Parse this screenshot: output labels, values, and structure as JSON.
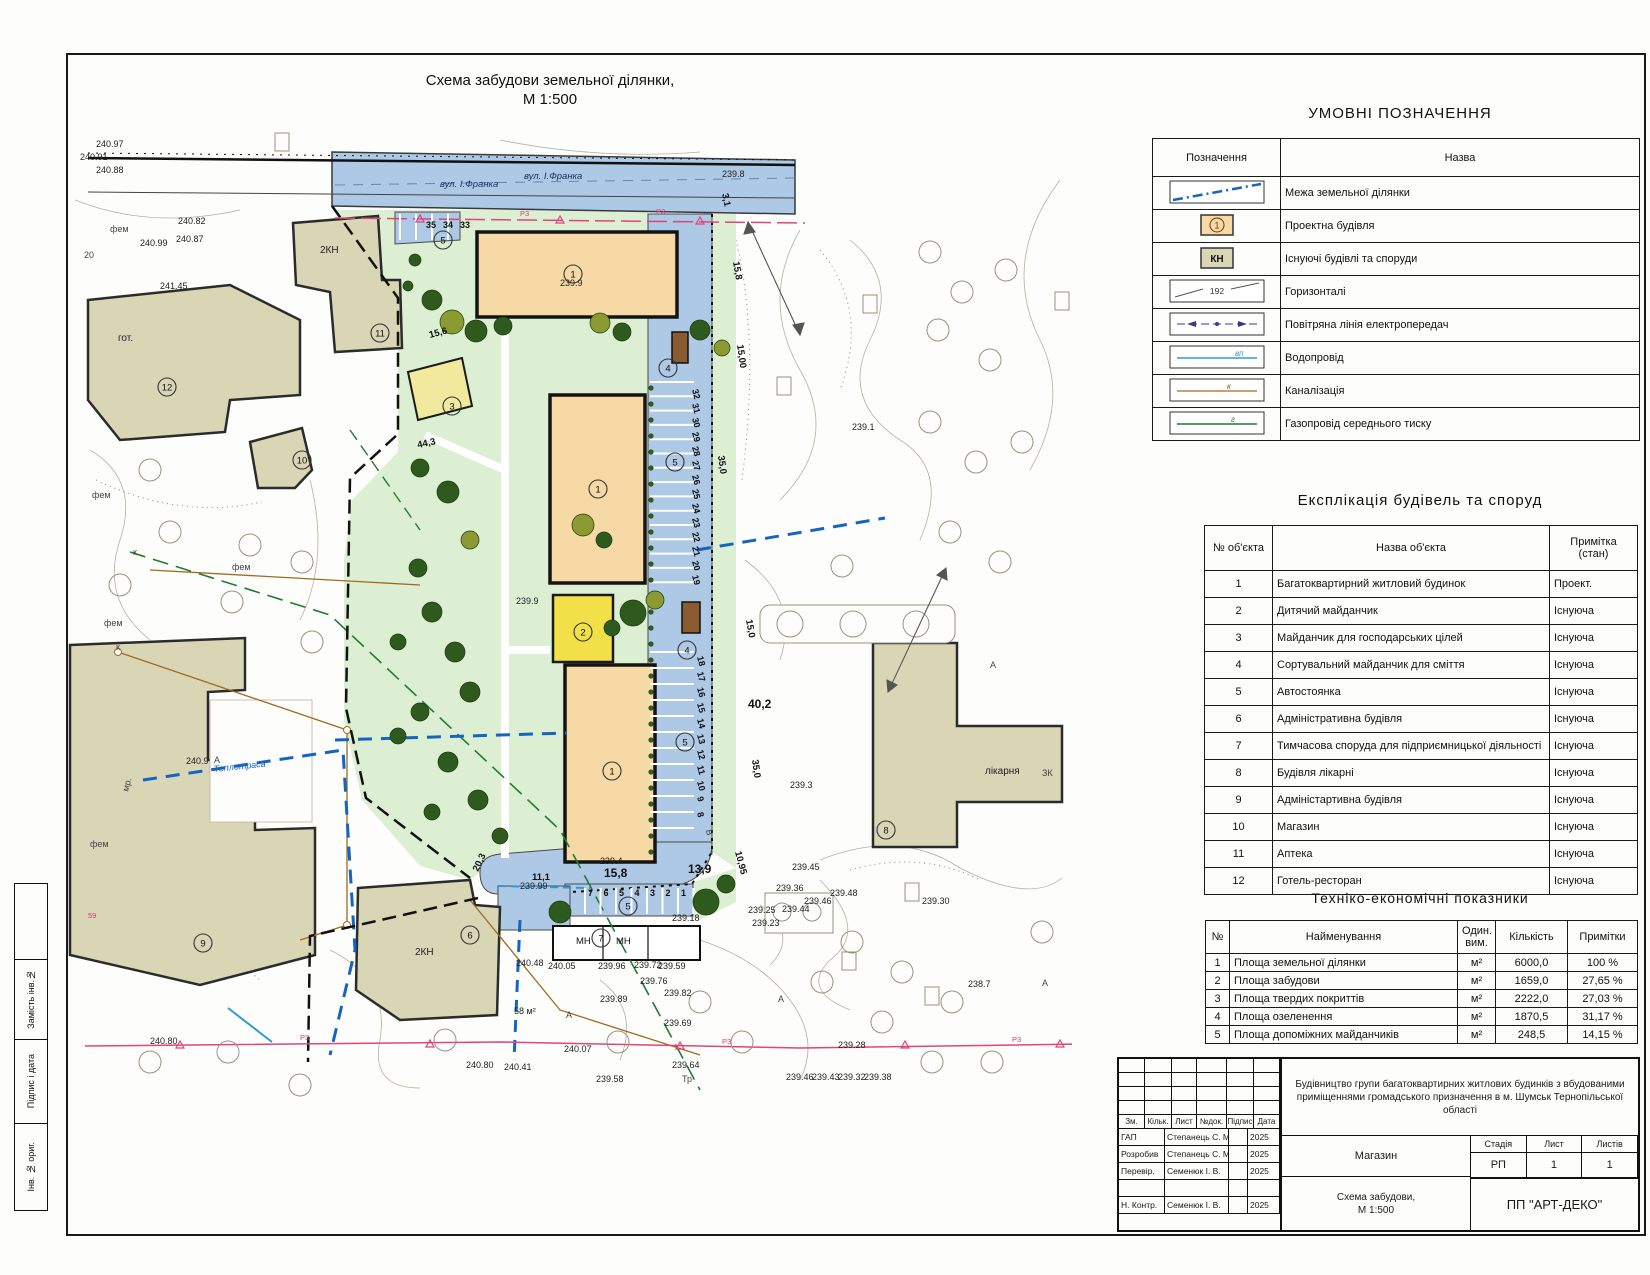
{
  "sheet": {
    "title_line1": "Схема забудови земельної ділянки,",
    "title_line2": "М 1:500"
  },
  "side_strip": [
    "Замість інв.№",
    "Підпис і дата",
    "Інв. № ориг."
  ],
  "legend": {
    "title": "УМОВНІ ПОЗНАЧЕННЯ",
    "col_symbol": "Позначення",
    "col_name": "Назва",
    "rows": [
      {
        "symbol": "boundary-line",
        "name": "Межа земельної ділянки",
        "badge": ""
      },
      {
        "symbol": "project-building",
        "name": "Проектна будівля",
        "badge": "1"
      },
      {
        "symbol": "existing-building",
        "name": "Існуючі будівлі та споруди",
        "badge": "КН"
      },
      {
        "symbol": "contour",
        "name": "Горизонталі",
        "badge": "192"
      },
      {
        "symbol": "powerline",
        "name": "Повітряна лінія електропередач",
        "badge": ""
      },
      {
        "symbol": "water",
        "name": "Водопровід",
        "badge": "вп"
      },
      {
        "symbol": "sewer",
        "name": "Каналізація",
        "badge": "к"
      },
      {
        "symbol": "gas",
        "name": "Газопровід середнього тиску",
        "badge": "г"
      }
    ]
  },
  "explication": {
    "title": "Експлікація будівель та споруд",
    "col_num": "№ об'єкта",
    "col_name": "Назва об'єкта",
    "col_note": "Примітка (стан)",
    "rows": [
      {
        "num": "1",
        "name": "Багатоквартирний житловий будинок",
        "note": "Проект."
      },
      {
        "num": "2",
        "name": "Дитячий майданчик",
        "note": "Існуюча"
      },
      {
        "num": "3",
        "name": "Майданчик для господарських цілей",
        "note": "Існуюча"
      },
      {
        "num": "4",
        "name": "Сортувальний майданчик для сміття",
        "note": "Існуюча"
      },
      {
        "num": "5",
        "name": "Автостоянка",
        "note": "Існуюча"
      },
      {
        "num": "6",
        "name": "Адміністративна будівля",
        "note": "Існуюча"
      },
      {
        "num": "7",
        "name": "Тимчасова споруда для підприємницької діяльності",
        "note": "Існуюча"
      },
      {
        "num": "8",
        "name": "Будівля лікарні",
        "note": "Існуюча"
      },
      {
        "num": "9",
        "name": "Адміністартивна будівля",
        "note": "Існуюча"
      },
      {
        "num": "10",
        "name": "Магазин",
        "note": "Існуюча"
      },
      {
        "num": "11",
        "name": "Аптека",
        "note": "Існуюча"
      },
      {
        "num": "12",
        "name": "Готель-ресторан",
        "note": "Існуюча"
      }
    ]
  },
  "indicators": {
    "title": "Техніко-економічні показники",
    "col_num": "№",
    "col_name": "Найменування",
    "col_unit": "Один. вим.",
    "col_qty": "Кількість",
    "col_note": "Примітки",
    "rows": [
      {
        "num": "1",
        "name": "Площа земельної ділянки",
        "unit": "м²",
        "qty": "6000,0",
        "note": "100 %"
      },
      {
        "num": "2",
        "name": "Площа забудови",
        "unit": "м²",
        "qty": "1659,0",
        "note": "27,65 %"
      },
      {
        "num": "3",
        "name": "Площа твердих покриттів",
        "unit": "м²",
        "qty": "2222,0",
        "note": "27,03 %"
      },
      {
        "num": "4",
        "name": "Площа озеленення",
        "unit": "м²",
        "qty": "1870,5",
        "note": "31,17 %"
      },
      {
        "num": "5",
        "name": "Площа допоміжних майданчиків",
        "unit": "м²",
        "qty": "248,5",
        "note": "14,15 %"
      }
    ]
  },
  "title_block": {
    "sig_headers": [
      "Зм.",
      "Кільк.",
      "Лист",
      "№док.",
      "Підпис",
      "Дата"
    ],
    "sig_rows": [
      {
        "role": "ГАП",
        "name": "Степанець С. М.",
        "sign": "",
        "date": "2025"
      },
      {
        "role": "Розробив",
        "name": "Степанець С. М.",
        "sign": "",
        "date": "2025"
      },
      {
        "role": "Перевір.",
        "name": "Семенюк І. В.",
        "sign": "",
        "date": "2025"
      },
      {
        "role": "",
        "name": "",
        "sign": "",
        "date": ""
      },
      {
        "role": "Н. Контр.",
        "name": "Семенюк І. В.",
        "sign": "",
        "date": "2025"
      }
    ],
    "project": "Будівництво групи багатоквартирних житлових будинків з вбудованими приміщеннями громадського призначення в м. Шумськ Тернопільської області",
    "object": "Магазин",
    "stage_label": "Стадія",
    "sheet_label": "Лист",
    "sheets_label": "Листів",
    "stage": "РП",
    "sheet": "1",
    "sheets": "1",
    "doc_line1": "Схема забудови,",
    "doc_line2": "М 1:500",
    "company": "ПП \"АРТ-ДЕКО\""
  },
  "map": {
    "colors": {
      "road": "#adc9e5",
      "lawn": "#dcefd3",
      "project_building": "#f6d9a4",
      "existing_building": "#d9d6b6",
      "playground": "#f2e049",
      "utility_pad": "#f1ea9e",
      "boundary_blue": "#1565c0",
      "gas_green": "#1f7d32",
      "sewer_tan": "#a06a1f",
      "pink_line": "#e0457b",
      "tree_dark": "#2f5a1d",
      "tree_olive": "#8c9b31"
    },
    "labels": [
      {
        "t": "вул. І.Франка",
        "x": 440,
        "y": 187,
        "c": "street"
      },
      {
        "t": "вул. І.Франка",
        "x": 524,
        "y": 179,
        "c": "street"
      },
      {
        "t": "239.8",
        "x": 722,
        "y": 177,
        "c": "elev"
      },
      {
        "t": "240.97",
        "x": 96,
        "y": 147,
        "c": "elev"
      },
      {
        "t": "240.91",
        "x": 80,
        "y": 160,
        "c": "elev"
      },
      {
        "t": "240.88",
        "x": 96,
        "y": 173,
        "c": "elev"
      },
      {
        "t": "240.82",
        "x": 178,
        "y": 224,
        "c": "elev"
      },
      {
        "t": "240.99",
        "x": 140,
        "y": 246,
        "c": "elev"
      },
      {
        "t": "240.87",
        "x": 176,
        "y": 242,
        "c": "elev"
      },
      {
        "t": "241.45",
        "x": 160,
        "y": 289,
        "c": "elev"
      },
      {
        "t": "20",
        "x": 84,
        "y": 258,
        "c": "letter"
      },
      {
        "t": "гот.",
        "x": 118,
        "y": 341,
        "c": "nameb"
      },
      {
        "t": "2КН",
        "x": 320,
        "y": 253,
        "c": "nameb"
      },
      {
        "t": "2КН",
        "x": 415,
        "y": 955,
        "c": "nameb"
      },
      {
        "t": "мр.",
        "x": 128,
        "y": 792,
        "c": "letter",
        "r": -75
      },
      {
        "t": "фем",
        "x": 110,
        "y": 232,
        "c": "letter"
      },
      {
        "t": "фем",
        "x": 92,
        "y": 498,
        "c": "letter"
      },
      {
        "t": "фем",
        "x": 104,
        "y": 626,
        "c": "letter"
      },
      {
        "t": "фем",
        "x": 90,
        "y": 847,
        "c": "letter"
      },
      {
        "t": "фем",
        "x": 232,
        "y": 570,
        "c": "letter"
      },
      {
        "t": "к",
        "x": 133,
        "y": 555,
        "c": "letter"
      },
      {
        "t": "к",
        "x": 116,
        "y": 650,
        "c": "letter"
      },
      {
        "t": "35",
        "x": 426,
        "y": 228,
        "c": "stall"
      },
      {
        "t": "34",
        "x": 443,
        "y": 228,
        "c": "stall"
      },
      {
        "t": "33",
        "x": 460,
        "y": 228,
        "c": "stall"
      },
      {
        "t": "15,6",
        "x": 430,
        "y": 338,
        "c": "dim",
        "r": -15
      },
      {
        "t": "44,3",
        "x": 418,
        "y": 448,
        "c": "dim",
        "r": -12
      },
      {
        "t": "239.9",
        "x": 560,
        "y": 286,
        "c": "elev"
      },
      {
        "t": "239.9",
        "x": 516,
        "y": 604,
        "c": "elev"
      },
      {
        "t": "239.1",
        "x": 852,
        "y": 430,
        "c": "elev"
      },
      {
        "t": "3,1",
        "x": 722,
        "y": 194,
        "c": "dim",
        "r": 78
      },
      {
        "t": "15,8",
        "x": 733,
        "y": 262,
        "c": "dim",
        "r": 80
      },
      {
        "t": "15,00",
        "x": 737,
        "y": 345,
        "c": "dim",
        "r": 82
      },
      {
        "t": "35,0",
        "x": 718,
        "y": 456,
        "c": "dim",
        "r": 82
      },
      {
        "t": "15,0",
        "x": 746,
        "y": 620,
        "c": "dim",
        "r": 80
      },
      {
        "t": "40,2",
        "x": 748,
        "y": 708,
        "c": "dimb"
      },
      {
        "t": "35,0",
        "x": 752,
        "y": 760,
        "c": "dim",
        "r": 82
      },
      {
        "t": "10,95",
        "x": 735,
        "y": 852,
        "c": "dim",
        "r": 75
      },
      {
        "t": "239.3",
        "x": 790,
        "y": 788,
        "c": "elev"
      },
      {
        "t": "лікарня",
        "x": 985,
        "y": 774,
        "c": "nameb"
      },
      {
        "t": "ЗК",
        "x": 1042,
        "y": 776,
        "c": "letter"
      },
      {
        "t": "А",
        "x": 990,
        "y": 668,
        "c": "letter"
      },
      {
        "t": "А",
        "x": 214,
        "y": 763,
        "c": "letter"
      },
      {
        "t": "А",
        "x": 778,
        "y": 1002,
        "c": "letter"
      },
      {
        "t": "А",
        "x": 1042,
        "y": 986,
        "c": "letter"
      },
      {
        "t": "А",
        "x": 566,
        "y": 1018,
        "c": "letter"
      },
      {
        "t": "20,3",
        "x": 478,
        "y": 872,
        "c": "dim",
        "r": -65
      },
      {
        "t": "11,1",
        "x": 532,
        "y": 880,
        "c": "dim"
      },
      {
        "t": "239.99",
        "x": 520,
        "y": 889,
        "c": "elev"
      },
      {
        "t": "239.4",
        "x": 600,
        "y": 864,
        "c": "elev"
      },
      {
        "t": "15,8",
        "x": 604,
        "y": 877,
        "c": "dimb"
      },
      {
        "t": "13,9",
        "x": 688,
        "y": 873,
        "c": "dimb"
      },
      {
        "t": "239.18",
        "x": 672,
        "y": 921,
        "c": "elev"
      },
      {
        "t": "МН",
        "x": 576,
        "y": 944,
        "c": "ctext"
      },
      {
        "t": "МН",
        "x": 616,
        "y": 944,
        "c": "ctext"
      },
      {
        "t": "В",
        "x": 706,
        "y": 830,
        "c": "letter",
        "r": 80
      },
      {
        "t": "240.48",
        "x": 516,
        "y": 966,
        "c": "elev"
      },
      {
        "t": "240.05",
        "x": 548,
        "y": 969,
        "c": "elev"
      },
      {
        "t": "239.96",
        "x": 598,
        "y": 969,
        "c": "elev"
      },
      {
        "t": "239.72",
        "x": 634,
        "y": 968,
        "c": "elev"
      },
      {
        "t": "239.59",
        "x": 658,
        "y": 969,
        "c": "elev"
      },
      {
        "t": "239.76",
        "x": 640,
        "y": 984,
        "c": "elev"
      },
      {
        "t": "239.82",
        "x": 664,
        "y": 996,
        "c": "elev"
      },
      {
        "t": "239.89",
        "x": 600,
        "y": 1002,
        "c": "elev"
      },
      {
        "t": "239.69",
        "x": 664,
        "y": 1026,
        "c": "elev"
      },
      {
        "t": "58 м²",
        "x": 514,
        "y": 1014,
        "c": "elev"
      },
      {
        "t": "240.07",
        "x": 564,
        "y": 1052,
        "c": "elev"
      },
      {
        "t": "240.80",
        "x": 150,
        "y": 1044,
        "c": "elev"
      },
      {
        "t": "240.80",
        "x": 466,
        "y": 1068,
        "c": "elev"
      },
      {
        "t": "240.41",
        "x": 504,
        "y": 1070,
        "c": "elev"
      },
      {
        "t": "239.64",
        "x": 672,
        "y": 1068,
        "c": "elev"
      },
      {
        "t": "239.58",
        "x": 596,
        "y": 1082,
        "c": "elev"
      },
      {
        "t": "Тр",
        "x": 682,
        "y": 1082,
        "c": "letter"
      },
      {
        "t": "239.46",
        "x": 786,
        "y": 1080,
        "c": "elev"
      },
      {
        "t": "239.43",
        "x": 812,
        "y": 1080,
        "c": "elev"
      },
      {
        "t": "239.32",
        "x": 838,
        "y": 1080,
        "c": "elev"
      },
      {
        "t": "239.38",
        "x": 864,
        "y": 1080,
        "c": "elev"
      },
      {
        "t": "239.28",
        "x": 838,
        "y": 1048,
        "c": "elev"
      },
      {
        "t": "238.7",
        "x": 968,
        "y": 987,
        "c": "elev"
      },
      {
        "t": "239.25",
        "x": 748,
        "y": 913,
        "c": "elev"
      },
      {
        "t": "239.23",
        "x": 752,
        "y": 926,
        "c": "elev"
      },
      {
        "t": "239.45",
        "x": 792,
        "y": 870,
        "c": "elev"
      },
      {
        "t": "239.30",
        "x": 922,
        "y": 904,
        "c": "elev"
      },
      {
        "t": "239.36",
        "x": 776,
        "y": 891,
        "c": "elev"
      },
      {
        "t": "239.48",
        "x": 830,
        "y": 896,
        "c": "elev"
      },
      {
        "t": "239.46",
        "x": 804,
        "y": 904,
        "c": "elev"
      },
      {
        "t": "239.44",
        "x": 782,
        "y": 912,
        "c": "elev"
      },
      {
        "t": "Теплотраса",
        "x": 214,
        "y": 772,
        "c": "heat",
        "r": -6
      },
      {
        "t": "240.9",
        "x": 186,
        "y": 764,
        "c": "elev"
      },
      {
        "t": "59",
        "x": 88,
        "y": 918,
        "c": "pinkt"
      },
      {
        "t": "Р3",
        "x": 520,
        "y": 216,
        "c": "pinkt"
      },
      {
        "t": "Р3",
        "x": 656,
        "y": 214,
        "c": "pinkt"
      },
      {
        "t": "Р3",
        "x": 300,
        "y": 1040,
        "c": "pinkt"
      },
      {
        "t": "Р3",
        "x": 722,
        "y": 1044,
        "c": "pinkt"
      },
      {
        "t": "Р3",
        "x": 1012,
        "y": 1042,
        "c": "pinkt"
      }
    ],
    "stall_numbers_right": [
      "32",
      "31",
      "30",
      "29",
      "28",
      "27",
      "26",
      "25",
      "24",
      "23",
      "22",
      "21",
      "20",
      "19"
    ],
    "stall_numbers_right2": [
      "18",
      "17",
      "16",
      "15",
      "14",
      "13",
      "12",
      "11",
      "10",
      "9",
      "8"
    ],
    "stall_numbers_bottom": [
      "7",
      "6",
      "5",
      "4",
      "3",
      "2",
      "1"
    ],
    "circled": [
      {
        "n": "1",
        "x": 573,
        "y": 274
      },
      {
        "n": "1",
        "x": 598,
        "y": 489
      },
      {
        "n": "1",
        "x": 612,
        "y": 771
      },
      {
        "n": "2",
        "x": 583,
        "y": 632
      },
      {
        "n": "3",
        "x": 452,
        "y": 406
      },
      {
        "n": "4",
        "x": 668,
        "y": 368
      },
      {
        "n": "4",
        "x": 687,
        "y": 650
      },
      {
        "n": "5",
        "x": 443,
        "y": 240
      },
      {
        "n": "5",
        "x": 675,
        "y": 462
      },
      {
        "n": "5",
        "x": 685,
        "y": 742
      },
      {
        "n": "5",
        "x": 628,
        "y": 906
      },
      {
        "n": "6",
        "x": 470,
        "y": 935
      },
      {
        "n": "7",
        "x": 601,
        "y": 938
      },
      {
        "n": "8",
        "x": 886,
        "y": 830
      },
      {
        "n": "9",
        "x": 203,
        "y": 943
      },
      {
        "n": "10",
        "x": 302,
        "y": 460
      },
      {
        "n": "11",
        "x": 380,
        "y": 333
      },
      {
        "n": "12",
        "x": 167,
        "y": 387
      }
    ]
  }
}
